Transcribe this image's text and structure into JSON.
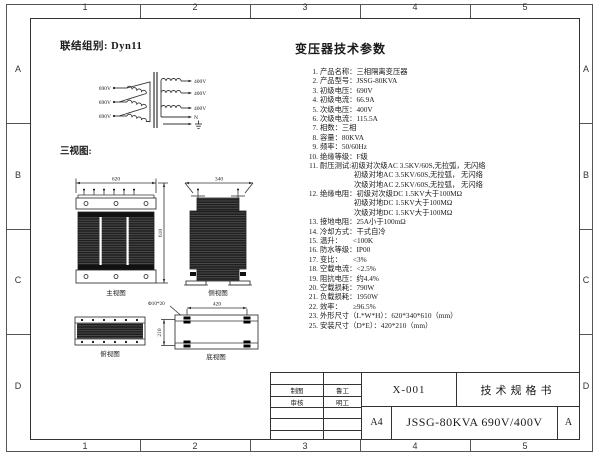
{
  "frame": {
    "cols": [
      "1",
      "2",
      "3",
      "4",
      "5"
    ],
    "rows": [
      "A",
      "B",
      "C",
      "D"
    ]
  },
  "header": {
    "connection_group": "联结组别: Dyn11"
  },
  "winding": {
    "primary": [
      "690V",
      "690V",
      "690V"
    ],
    "secondary": [
      "400V",
      "400V",
      "400V"
    ],
    "neutral": "N"
  },
  "views": {
    "section_label": "三视图:",
    "front": {
      "label": "主视图",
      "width": "620",
      "height": "610"
    },
    "side": {
      "label": "侧视图",
      "width": "340"
    },
    "top": {
      "label": "俯视图"
    },
    "bottom": {
      "label": "底视图",
      "width": "420",
      "height": "210",
      "slot": "Φ10*20"
    }
  },
  "params": {
    "title": "变压器技术参数",
    "lines": [
      {
        "n": "1.",
        "t": "产品名称：三相隔离变压器"
      },
      {
        "n": "2.",
        "t": "产品型号：JSSG-80KVA"
      },
      {
        "n": "3.",
        "t": "初级电压：690V"
      },
      {
        "n": "4.",
        "t": "初级电流：66.9A"
      },
      {
        "n": "5.",
        "t": "次级电压：400V"
      },
      {
        "n": "6.",
        "t": "次级电流：115.5A"
      },
      {
        "n": "7.",
        "t": "相数：三相"
      },
      {
        "n": "8.",
        "t": "容量：80KVA"
      },
      {
        "n": "9.",
        "t": "频率：50/60Hz"
      },
      {
        "n": "10.",
        "t": "绝缘等级：F级"
      },
      {
        "n": "11.",
        "t": "耐压测试:初级对次级AC 3.5KV/60S,无拉弧，无闪络"
      },
      {
        "n": "",
        "t": "初级对地AC 3.5KV/60S,无拉弧， 无闪络"
      },
      {
        "n": "",
        "t": "次级对地AC 2.5KV/60S,无拉弧， 无闪络"
      },
      {
        "n": "12.",
        "t": "绝缘电阻：初级对次级DC 1.5KV大于100MΩ"
      },
      {
        "n": "",
        "t": "初级对地DC 1.5KV大于100MΩ"
      },
      {
        "n": "",
        "t": "次级对地DC 1.5KV大于100MΩ"
      },
      {
        "n": "13.",
        "t": "接地电阻：25A小于100mΩ"
      },
      {
        "n": "14.",
        "t": "冷却方式：干式自冷"
      },
      {
        "n": "15.",
        "t": "温升：　　<100K"
      },
      {
        "n": "16.",
        "t": "防水等级：IP00"
      },
      {
        "n": "17.",
        "t": "变比：　　<3%"
      },
      {
        "n": "18.",
        "t": "空载电流：<2.5%"
      },
      {
        "n": "19.",
        "t": "阻抗电压：约4.4%"
      },
      {
        "n": "20.",
        "t": "空载损耗：790W"
      },
      {
        "n": "21.",
        "t": "负载损耗：1950W"
      },
      {
        "n": "22.",
        "t": "效率：　　≥96.5%"
      },
      {
        "n": "23.",
        "t": "外形尺寸（L*W*H）：620*340*610（mm）"
      },
      {
        "n": "25.",
        "t": "安装尺寸（D*E）：420*210（mm）"
      }
    ]
  },
  "title_block": {
    "drafter_label": "制图",
    "drafter": "鲁工",
    "checker_label": "审核",
    "checker": "明工",
    "doc_no": "X-001",
    "doc_title": "技术规格书",
    "paper_size": "A4",
    "product": "JSSG-80KVA 690V/400V",
    "revision": "A"
  },
  "colors": {
    "line": "#444444",
    "text": "#1a1a1a",
    "coil_dark": "#1f1f1f"
  }
}
